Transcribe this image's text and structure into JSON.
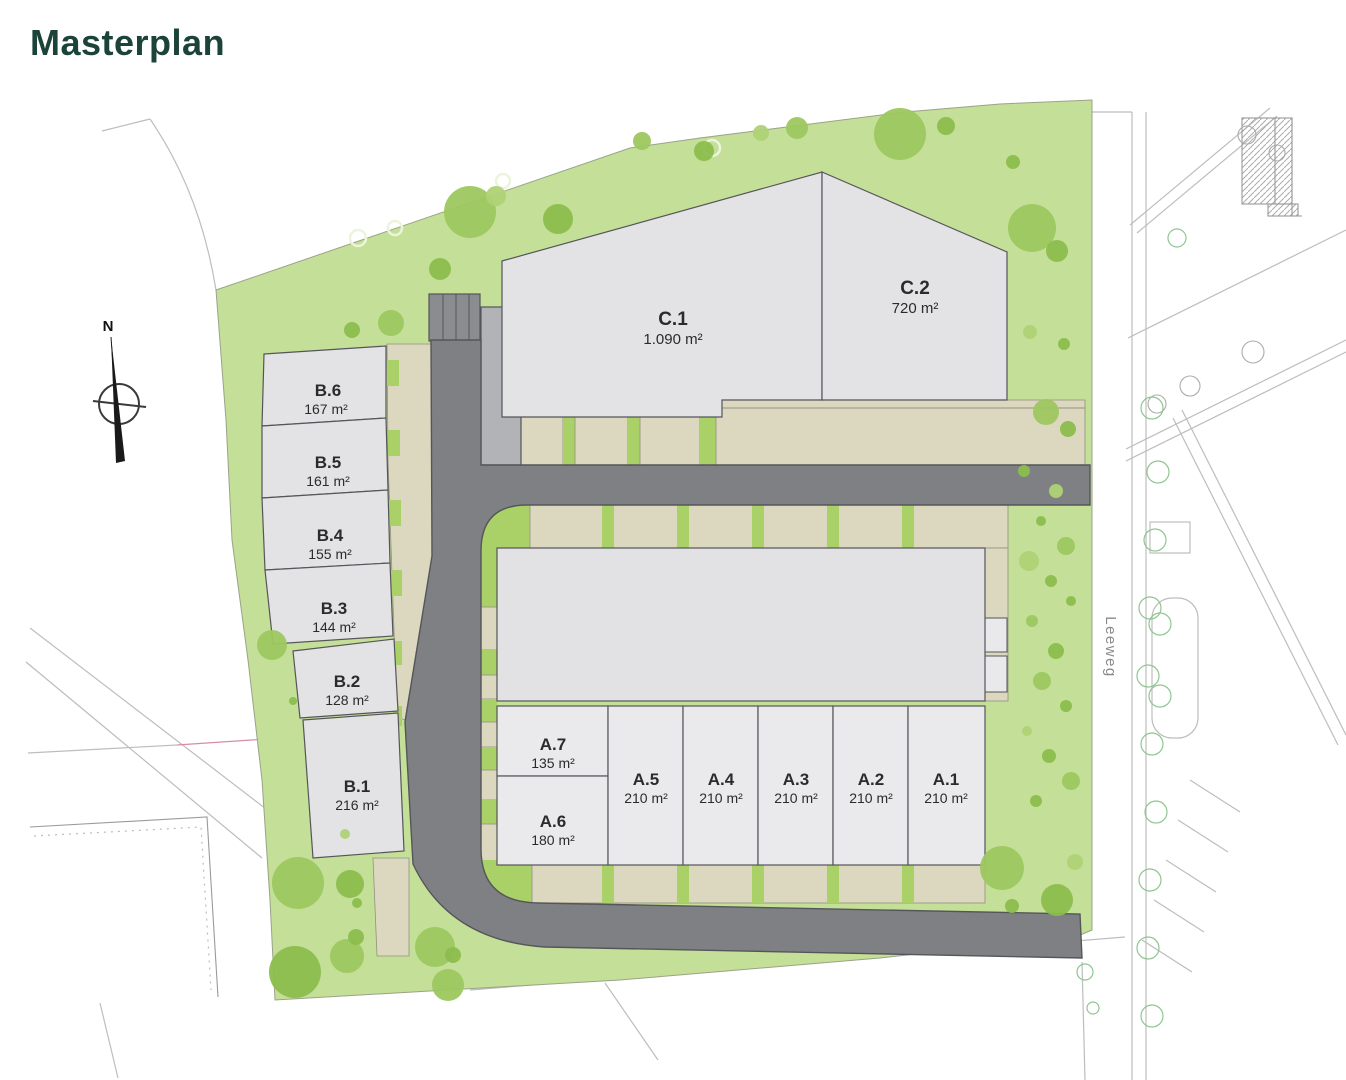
{
  "page": {
    "title": "Masterplan"
  },
  "compass": {
    "label": "N"
  },
  "street": {
    "name": "Leeweg"
  },
  "plots": {
    "a": [
      {
        "id": "A.1",
        "area": "210 m²"
      },
      {
        "id": "A.2",
        "area": "210 m²"
      },
      {
        "id": "A.3",
        "area": "210 m²"
      },
      {
        "id": "A.4",
        "area": "210 m²"
      },
      {
        "id": "A.5",
        "area": "210 m²"
      },
      {
        "id": "A.6",
        "area": "180 m²"
      },
      {
        "id": "A.7",
        "area": "135 m²"
      }
    ],
    "b": [
      {
        "id": "B.1",
        "area": "216 m²"
      },
      {
        "id": "B.2",
        "area": "128 m²"
      },
      {
        "id": "B.3",
        "area": "144 m²"
      },
      {
        "id": "B.4",
        "area": "155 m²"
      },
      {
        "id": "B.5",
        "area": "161 m²"
      },
      {
        "id": "B.6",
        "area": "167 m²"
      }
    ],
    "c": [
      {
        "id": "C.1",
        "area": "1.090 m²"
      },
      {
        "id": "C.2",
        "area": "720 m²"
      }
    ]
  },
  "colors": {
    "title": "#1C4339",
    "site_green": "#C4DF97",
    "tree_green": "#8CBD4D",
    "road_gray": "#7F8083",
    "plot_gray": "#E3E3E5",
    "path_beige": "#DCD7BF",
    "separator_green": "#A9D168"
  }
}
